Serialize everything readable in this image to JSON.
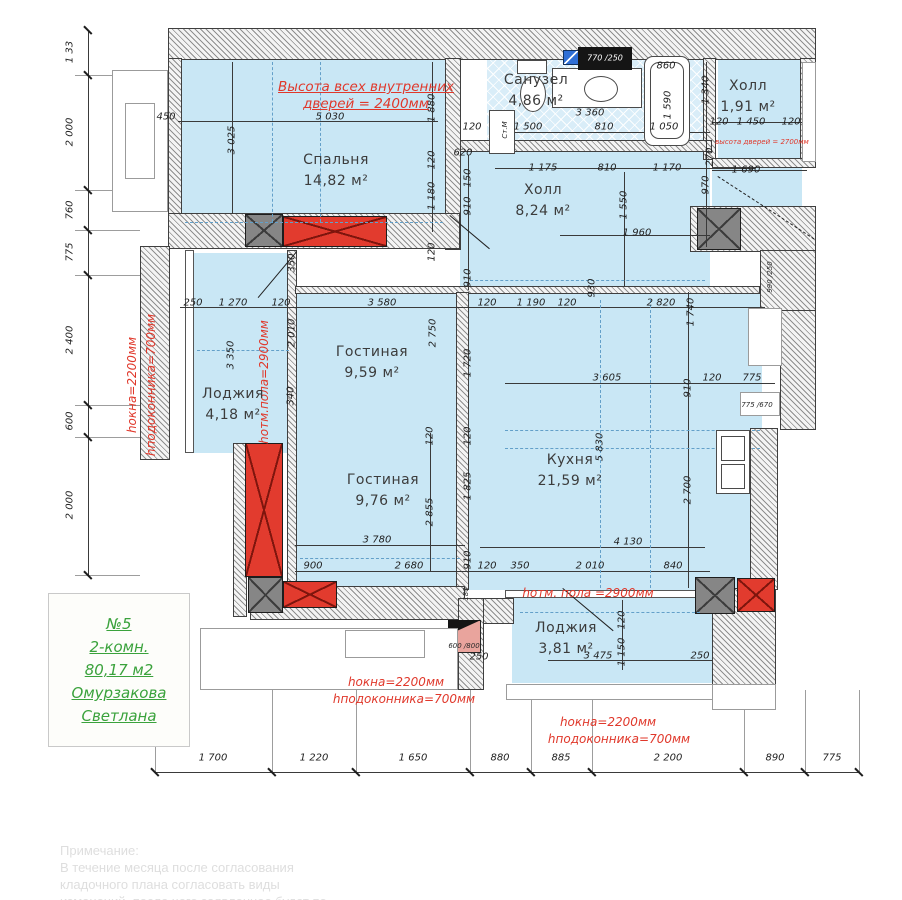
{
  "colors": {
    "room_fill": "#c9e7f5",
    "wall_hatch": "#8f8f8f",
    "vent_red": "#e23b2e",
    "shaft_gray": "#868686",
    "annotation_red": "#e0382b",
    "info_green": "#3aa23c",
    "panel_blue": "#2f6fd6"
  },
  "info_box": {
    "lines": [
      "№5",
      "2-комн.",
      "80,17 м2",
      "Омурзакова",
      "Светлана"
    ]
  },
  "note": {
    "lines": [
      "Примечание:",
      "  В течение месяца после согласования",
      "кладочного   плана   согласовать   виды",
      "изменений, после чего заявленное будет по"
    ]
  },
  "rooms": [
    {
      "name": "Спальня",
      "area": "14,82 м²",
      "x": 336,
      "y": 160
    },
    {
      "name": "Санузел",
      "area": "4,86 м²",
      "x": 536,
      "y": 80
    },
    {
      "name": "Холл",
      "area": "1,91 м²",
      "x": 748,
      "y": 86
    },
    {
      "name": "Холл",
      "area": "8,24 м²",
      "x": 543,
      "y": 190
    },
    {
      "name": "Гостиная",
      "area": "9,59 м²",
      "x": 372,
      "y": 352
    },
    {
      "name": "Лоджия",
      "area": "4,18 м²",
      "x": 233,
      "y": 394
    },
    {
      "name": "Гостиная",
      "area": "9,76 м²",
      "x": 383,
      "y": 480
    },
    {
      "name": "Кухня",
      "area": "21,59 м²",
      "x": 570,
      "y": 460
    },
    {
      "name": "Лоджия",
      "area": "3,81 м²",
      "x": 566,
      "y": 628
    }
  ],
  "red_notes": [
    {
      "t": "Высота всех внутренних",
      "x": 366,
      "y": 87,
      "r": 0,
      "c": "ru"
    },
    {
      "t": "дверей = 2400мм",
      "x": 366,
      "y": 104,
      "r": 0,
      "c": "ru"
    },
    {
      "t": "hокна=2200мм",
      "x": 132,
      "y": 385,
      "r": -90,
      "c": "r"
    },
    {
      "t": "hподоконника=700мм",
      "x": 151,
      "y": 385,
      "r": -90,
      "c": "r"
    },
    {
      "t": "hотм.пола=2900мм",
      "x": 264,
      "y": 382,
      "r": -90,
      "c": "r"
    },
    {
      "t": "hотм. пола =2900мм",
      "x": 588,
      "y": 593,
      "r": 0,
      "c": "r"
    },
    {
      "t": "высота дверей = 2700мм",
      "x": 762,
      "y": 142,
      "r": 0,
      "c": "rt"
    },
    {
      "t": "hокна=2200мм",
      "x": 396,
      "y": 682,
      "r": 0,
      "c": "r"
    },
    {
      "t": "hподоконника=700мм",
      "x": 404,
      "y": 699,
      "r": 0,
      "c": "r"
    },
    {
      "t": "hокна=2200мм",
      "x": 608,
      "y": 722,
      "r": 0,
      "c": "r"
    },
    {
      "t": "hподоконника=700мм",
      "x": 619,
      "y": 739,
      "r": 0,
      "c": "r"
    }
  ],
  "left_dims": [
    {
      "t": "1 33",
      "y": 52
    },
    {
      "t": "2 000",
      "y": 132
    },
    {
      "t": "760",
      "y": 210
    },
    {
      "t": "775",
      "y": 252
    },
    {
      "t": "2 400",
      "y": 340
    },
    {
      "t": "600",
      "y": 421
    },
    {
      "t": "2 000",
      "y": 505
    }
  ],
  "bottom_dims": [
    {
      "t": "1 700",
      "x": 213
    },
    {
      "t": "1 220",
      "x": 314
    },
    {
      "t": "1 650",
      "x": 413
    },
    {
      "t": "880",
      "x": 500
    },
    {
      "t": "885",
      "x": 561
    },
    {
      "t": "2 200",
      "x": 668
    },
    {
      "t": "890",
      "x": 775
    },
    {
      "t": "775",
      "x": 832
    }
  ],
  "dims": [
    {
      "t": "450",
      "x": 166,
      "y": 117
    },
    {
      "t": "5 030",
      "x": 330,
      "y": 117
    },
    {
      "t": "3 025",
      "x": 232,
      "y": 140,
      "r": -90
    },
    {
      "t": "620",
      "x": 463,
      "y": 153
    },
    {
      "t": "1 880",
      "x": 432,
      "y": 108,
      "r": -90
    },
    {
      "t": "120",
      "x": 432,
      "y": 160,
      "r": -90
    },
    {
      "t": "1 180",
      "x": 432,
      "y": 196,
      "r": -90
    },
    {
      "t": "150",
      "x": 468,
      "y": 178,
      "r": -90
    },
    {
      "t": "910",
      "x": 468,
      "y": 206,
      "r": -90
    },
    {
      "t": "910",
      "x": 468,
      "y": 278,
      "r": -90
    },
    {
      "t": "120",
      "x": 432,
      "y": 252,
      "r": -90
    },
    {
      "t": "120",
      "x": 472,
      "y": 127
    },
    {
      "t": "1 500",
      "x": 528,
      "y": 127
    },
    {
      "t": "810",
      "x": 604,
      "y": 127
    },
    {
      "t": "1 050",
      "x": 664,
      "y": 127
    },
    {
      "t": "3 360",
      "x": 590,
      "y": 113
    },
    {
      "t": "860",
      "x": 666,
      "y": 66
    },
    {
      "t": "1 590",
      "x": 668,
      "y": 105,
      "r": -90
    },
    {
      "t": "Ст.М",
      "x": 505,
      "y": 130,
      "r": -90,
      "c": "dt"
    },
    {
      "t": "770 /250",
      "x": 605,
      "y": 58,
      "c": "wh"
    },
    {
      "t": "1 340",
      "x": 706,
      "y": 90,
      "r": -90
    },
    {
      "t": "120",
      "x": 719,
      "y": 122
    },
    {
      "t": "1 450",
      "x": 751,
      "y": 122
    },
    {
      "t": "120",
      "x": 791,
      "y": 122
    },
    {
      "t": "1 175",
      "x": 543,
      "y": 168
    },
    {
      "t": "810",
      "x": 607,
      "y": 168
    },
    {
      "t": "1 170",
      "x": 667,
      "y": 168
    },
    {
      "t": "1 690",
      "x": 746,
      "y": 170
    },
    {
      "t": "1 550",
      "x": 624,
      "y": 205,
      "r": -90
    },
    {
      "t": "1 960",
      "x": 637,
      "y": 233
    },
    {
      "t": "970",
      "x": 706,
      "y": 185,
      "r": -90
    },
    {
      "t": "270",
      "x": 710,
      "y": 157,
      "r": -90
    },
    {
      "t": "930",
      "x": 592,
      "y": 288,
      "r": -90
    },
    {
      "t": "990 /250",
      "x": 770,
      "y": 277,
      "r": -90,
      "c": "dt"
    },
    {
      "t": "250",
      "x": 193,
      "y": 303
    },
    {
      "t": "1 270",
      "x": 233,
      "y": 303
    },
    {
      "t": "120",
      "x": 281,
      "y": 303
    },
    {
      "t": "3 580",
      "x": 382,
      "y": 303
    },
    {
      "t": "120",
      "x": 487,
      "y": 303
    },
    {
      "t": "1 190",
      "x": 531,
      "y": 303
    },
    {
      "t": "120",
      "x": 567,
      "y": 303
    },
    {
      "t": "2 820",
      "x": 661,
      "y": 303
    },
    {
      "t": "1 740",
      "x": 691,
      "y": 312,
      "r": -90
    },
    {
      "t": "350",
      "x": 292,
      "y": 263,
      "r": -90
    },
    {
      "t": "2 010",
      "x": 292,
      "y": 333,
      "r": -90
    },
    {
      "t": "340",
      "x": 291,
      "y": 396,
      "r": -90
    },
    {
      "t": "3 350",
      "x": 231,
      "y": 355,
      "r": -90
    },
    {
      "t": "2 750",
      "x": 433,
      "y": 333,
      "r": -90
    },
    {
      "t": "1 720",
      "x": 468,
      "y": 363,
      "r": -90
    },
    {
      "t": "3 605",
      "x": 607,
      "y": 378
    },
    {
      "t": "910",
      "x": 688,
      "y": 388,
      "r": -90
    },
    {
      "t": "120",
      "x": 712,
      "y": 378
    },
    {
      "t": "775",
      "x": 752,
      "y": 378
    },
    {
      "t": "775 /670",
      "x": 757,
      "y": 405,
      "c": "dt"
    },
    {
      "t": "5 830",
      "x": 600,
      "y": 447,
      "r": -90
    },
    {
      "t": "2 700",
      "x": 688,
      "y": 490,
      "r": -90
    },
    {
      "t": "2 855",
      "x": 430,
      "y": 512,
      "r": -90
    },
    {
      "t": "1 825",
      "x": 468,
      "y": 486,
      "r": -90
    },
    {
      "t": "120",
      "x": 430,
      "y": 436,
      "r": -90
    },
    {
      "t": "120",
      "x": 468,
      "y": 436,
      "r": -90
    },
    {
      "t": "3 780",
      "x": 377,
      "y": 540
    },
    {
      "t": "900",
      "x": 313,
      "y": 566
    },
    {
      "t": "2 680",
      "x": 409,
      "y": 566
    },
    {
      "t": "910",
      "x": 468,
      "y": 560,
      "r": -90
    },
    {
      "t": "120",
      "x": 487,
      "y": 566
    },
    {
      "t": "350",
      "x": 520,
      "y": 566
    },
    {
      "t": "2 010",
      "x": 590,
      "y": 566
    },
    {
      "t": "840",
      "x": 673,
      "y": 566
    },
    {
      "t": "4 130",
      "x": 628,
      "y": 542
    },
    {
      "t": "120",
      "x": 622,
      "y": 620,
      "r": -90
    },
    {
      "t": "3 475",
      "x": 598,
      "y": 656
    },
    {
      "t": "1 150",
      "x": 622,
      "y": 652,
      "r": -90
    },
    {
      "t": "250",
      "x": 479,
      "y": 657
    },
    {
      "t": "250",
      "x": 700,
      "y": 656
    },
    {
      "t": "180",
      "x": 466,
      "y": 594,
      "r": -90,
      "c": "dt"
    },
    {
      "t": "600 /800",
      "x": 464,
      "y": 646,
      "c": "dt"
    }
  ],
  "fills": [
    {
      "x": 175,
      "y": 58,
      "w": 270,
      "h": 174
    },
    {
      "x": 487,
      "y": 58,
      "w": 216,
      "h": 90,
      "k": "tile"
    },
    {
      "x": 718,
      "y": 58,
      "w": 85,
      "h": 105
    },
    {
      "x": 712,
      "y": 168,
      "w": 90,
      "h": 82
    },
    {
      "x": 460,
      "y": 152,
      "w": 250,
      "h": 138
    },
    {
      "x": 295,
      "y": 290,
      "w": 467,
      "h": 300
    },
    {
      "x": 192,
      "y": 253,
      "w": 100,
      "h": 200
    },
    {
      "x": 512,
      "y": 595,
      "w": 200,
      "h": 88
    }
  ],
  "walls": [
    {
      "x": 168,
      "y": 28,
      "w": 648,
      "h": 32
    },
    {
      "x": 168,
      "y": 58,
      "w": 14,
      "h": 190
    },
    {
      "x": 445,
      "y": 58,
      "w": 16,
      "h": 192
    },
    {
      "x": 800,
      "y": 58,
      "w": 16,
      "h": 106
    },
    {
      "x": 703,
      "y": 58,
      "w": 13,
      "h": 102
    },
    {
      "x": 460,
      "y": 140,
      "w": 252,
      "h": 12
    },
    {
      "x": 712,
      "y": 158,
      "w": 104,
      "h": 10
    },
    {
      "x": 168,
      "y": 213,
      "w": 292,
      "h": 36
    },
    {
      "x": 690,
      "y": 206,
      "w": 126,
      "h": 46
    },
    {
      "x": 140,
      "y": 246,
      "w": 30,
      "h": 214
    },
    {
      "x": 185,
      "y": 250,
      "w": 9,
      "h": 203,
      "k": "thin"
    },
    {
      "x": 287,
      "y": 250,
      "w": 10,
      "h": 340
    },
    {
      "x": 295,
      "y": 286,
      "w": 465,
      "h": 8
    },
    {
      "x": 456,
      "y": 292,
      "w": 13,
      "h": 298
    },
    {
      "x": 233,
      "y": 443,
      "w": 14,
      "h": 174
    },
    {
      "x": 250,
      "y": 586,
      "w": 215,
      "h": 34
    },
    {
      "x": 458,
      "y": 598,
      "w": 56,
      "h": 26
    },
    {
      "x": 458,
      "y": 598,
      "w": 26,
      "h": 92
    },
    {
      "x": 505,
      "y": 590,
      "w": 210,
      "h": 8,
      "k": "thin"
    },
    {
      "x": 712,
      "y": 588,
      "w": 64,
      "h": 98
    },
    {
      "x": 760,
      "y": 250,
      "w": 56,
      "h": 62
    },
    {
      "x": 780,
      "y": 310,
      "w": 36,
      "h": 120
    },
    {
      "x": 750,
      "y": 428,
      "w": 28,
      "h": 162
    }
  ],
  "xblocks": [
    {
      "x": 283,
      "y": 216,
      "w": 104,
      "h": 31,
      "k": "red"
    },
    {
      "x": 245,
      "y": 443,
      "w": 38,
      "h": 134,
      "k": "red"
    },
    {
      "x": 283,
      "y": 581,
      "w": 54,
      "h": 27,
      "k": "red"
    },
    {
      "x": 737,
      "y": 578,
      "w": 38,
      "h": 34,
      "k": "red"
    },
    {
      "x": 245,
      "y": 214,
      "w": 38,
      "h": 33,
      "k": "gray"
    },
    {
      "x": 697,
      "y": 208,
      "w": 44,
      "h": 42,
      "k": "gray"
    },
    {
      "x": 248,
      "y": 577,
      "w": 35,
      "h": 36,
      "k": "gray"
    },
    {
      "x": 695,
      "y": 577,
      "w": 40,
      "h": 37,
      "k": "gray"
    }
  ],
  "lines": [
    {
      "x": 88,
      "y": 30,
      "w": 1,
      "h": 545
    },
    {
      "x": 155,
      "y": 772,
      "w": 705,
      "h": 1
    },
    {
      "x": 178,
      "y": 121,
      "w": 260,
      "h": 1
    },
    {
      "x": 495,
      "y": 132,
      "w": 215,
      "h": 1
    },
    {
      "x": 495,
      "y": 168,
      "w": 260,
      "h": 1
    },
    {
      "x": 712,
      "y": 122,
      "w": 95,
      "h": 1
    },
    {
      "x": 712,
      "y": 170,
      "w": 95,
      "h": 1
    },
    {
      "x": 560,
      "y": 235,
      "w": 150,
      "h": 1
    },
    {
      "x": 180,
      "y": 307,
      "w": 585,
      "h": 1
    },
    {
      "x": 505,
      "y": 383,
      "w": 270,
      "h": 1
    },
    {
      "x": 295,
      "y": 545,
      "w": 170,
      "h": 1
    },
    {
      "x": 480,
      "y": 547,
      "w": 225,
      "h": 1
    },
    {
      "x": 295,
      "y": 571,
      "w": 415,
      "h": 1
    },
    {
      "x": 548,
      "y": 660,
      "w": 165,
      "h": 1
    },
    {
      "x": 232,
      "y": 62,
      "w": 1,
      "h": 152
    },
    {
      "x": 432,
      "y": 62,
      "w": 1,
      "h": 170
    },
    {
      "x": 468,
      "y": 155,
      "w": 1,
      "h": 135
    },
    {
      "x": 624,
      "y": 172,
      "w": 1,
      "h": 115
    },
    {
      "x": 688,
      "y": 292,
      "w": 1,
      "h": 296
    },
    {
      "x": 706,
      "y": 62,
      "w": 1,
      "h": 185
    },
    {
      "x": 430,
      "y": 433,
      "w": 1,
      "h": 138
    },
    {
      "x": 468,
      "y": 433,
      "w": 1,
      "h": 138
    },
    {
      "x": 622,
      "y": 600,
      "w": 1,
      "h": 70
    },
    {
      "x": 75,
      "y": 75,
      "w": 65,
      "h": 1,
      "k": "lt"
    },
    {
      "x": 75,
      "y": 190,
      "w": 65,
      "h": 1,
      "k": "lt"
    },
    {
      "x": 75,
      "y": 230,
      "w": 65,
      "h": 1,
      "k": "lt"
    },
    {
      "x": 75,
      "y": 275,
      "w": 65,
      "h": 1,
      "k": "lt"
    },
    {
      "x": 75,
      "y": 405,
      "w": 65,
      "h": 1,
      "k": "lt"
    },
    {
      "x": 75,
      "y": 437,
      "w": 65,
      "h": 1,
      "k": "lt"
    },
    {
      "x": 75,
      "y": 575,
      "w": 65,
      "h": 1,
      "k": "lt"
    },
    {
      "x": 155,
      "y": 690,
      "w": 1,
      "h": 82,
      "k": "lt"
    },
    {
      "x": 272,
      "y": 690,
      "w": 1,
      "h": 82,
      "k": "lt"
    },
    {
      "x": 356,
      "y": 690,
      "w": 1,
      "h": 82,
      "k": "lt"
    },
    {
      "x": 470,
      "y": 690,
      "w": 1,
      "h": 82,
      "k": "lt"
    },
    {
      "x": 531,
      "y": 690,
      "w": 1,
      "h": 82,
      "k": "lt"
    },
    {
      "x": 592,
      "y": 690,
      "w": 1,
      "h": 82,
      "k": "lt"
    },
    {
      "x": 744,
      "y": 690,
      "w": 1,
      "h": 82,
      "k": "lt"
    },
    {
      "x": 805,
      "y": 690,
      "w": 1,
      "h": 82,
      "k": "lt"
    },
    {
      "x": 859,
      "y": 690,
      "w": 1,
      "h": 82,
      "k": "lt"
    }
  ],
  "dashes": [
    {
      "x": 272,
      "y": 62,
      "w": 1,
      "h": 160,
      "k": "v"
    },
    {
      "x": 320,
      "y": 62,
      "w": 1,
      "h": 160,
      "k": "v"
    },
    {
      "x": 185,
      "y": 222,
      "w": 258,
      "h": 1,
      "k": "h"
    },
    {
      "x": 470,
      "y": 280,
      "w": 235,
      "h": 1,
      "k": "h"
    },
    {
      "x": 600,
      "y": 300,
      "w": 1,
      "h": 288,
      "k": "v"
    },
    {
      "x": 650,
      "y": 300,
      "w": 1,
      "h": 288,
      "k": "v"
    },
    {
      "x": 505,
      "y": 430,
      "w": 255,
      "h": 1,
      "k": "h"
    },
    {
      "x": 505,
      "y": 448,
      "w": 255,
      "h": 1,
      "k": "h"
    },
    {
      "x": 300,
      "y": 558,
      "w": 160,
      "h": 1,
      "k": "h"
    },
    {
      "x": 520,
      "y": 612,
      "w": 180,
      "h": 1,
      "k": "h"
    },
    {
      "x": 197,
      "y": 350,
      "w": 92,
      "h": 1,
      "k": "h"
    }
  ],
  "diags": [
    {
      "x": 563,
      "y": 588,
      "len": 66,
      "ang": 40
    },
    {
      "x": 297,
      "y": 252,
      "len": 60,
      "ang": 130
    },
    {
      "x": 450,
      "y": 215,
      "len": 52,
      "ang": 40
    },
    {
      "x": 718,
      "y": 176,
      "len": 115,
      "ang": 33,
      "k": "dd"
    }
  ],
  "ticks": {
    "left_x": 88,
    "left_ys": [
      30,
      75,
      190,
      230,
      275,
      405,
      437,
      575
    ],
    "bottom_y": 772,
    "bottom_xs": [
      155,
      272,
      356,
      470,
      531,
      592,
      744,
      805,
      859
    ]
  },
  "shapes": [
    {
      "k": "fxl",
      "x": 112,
      "y": 70,
      "w": 56,
      "h": 142
    },
    {
      "k": "fxl",
      "x": 125,
      "y": 103,
      "w": 30,
      "h": 76
    },
    {
      "k": "fx",
      "x": 517,
      "y": 60,
      "w": 30,
      "h": 14
    },
    {
      "k": "fx ell",
      "x": 520,
      "y": 76,
      "w": 26,
      "h": 36
    },
    {
      "k": "fx",
      "x": 552,
      "y": 68,
      "w": 90,
      "h": 40
    },
    {
      "k": "fx ell",
      "x": 584,
      "y": 76,
      "w": 34,
      "h": 26
    },
    {
      "k": "fx rr",
      "x": 644,
      "y": 56,
      "w": 46,
      "h": 90
    },
    {
      "k": "fx rr",
      "x": 650,
      "y": 62,
      "w": 34,
      "h": 77
    },
    {
      "k": "fx",
      "x": 489,
      "y": 110,
      "w": 26,
      "h": 44
    },
    {
      "k": "fx",
      "x": 716,
      "y": 430,
      "w": 34,
      "h": 64
    },
    {
      "k": "fx",
      "x": 721,
      "y": 436,
      "w": 24,
      "h": 25
    },
    {
      "k": "fx",
      "x": 721,
      "y": 464,
      "w": 24,
      "h": 25
    },
    {
      "k": "blu",
      "x": 563,
      "y": 50,
      "w": 16,
      "h": 15
    },
    {
      "k": "blu",
      "x": 755,
      "y": 315,
      "w": 20,
      "h": 18
    },
    {
      "k": "blu",
      "x": 755,
      "y": 342,
      "w": 20,
      "h": 18
    },
    {
      "k": "blk",
      "x": 578,
      "y": 47,
      "w": 54,
      "h": 23
    },
    {
      "k": "fxl",
      "x": 748,
      "y": 308,
      "w": 34,
      "h": 58
    },
    {
      "k": "fxl",
      "x": 740,
      "y": 392,
      "w": 40,
      "h": 24
    },
    {
      "k": "pnk",
      "x": 448,
      "y": 620,
      "w": 33,
      "h": 33
    },
    {
      "k": "tri",
      "x": 448,
      "y": 620,
      "w": 33,
      "h": 15
    },
    {
      "k": "fxl",
      "x": 200,
      "y": 628,
      "w": 258,
      "h": 62
    },
    {
      "k": "fxl",
      "x": 345,
      "y": 630,
      "w": 80,
      "h": 28
    },
    {
      "k": "fxl",
      "x": 506,
      "y": 684,
      "w": 210,
      "h": 16
    },
    {
      "k": "fxl",
      "x": 712,
      "y": 684,
      "w": 64,
      "h": 26
    },
    {
      "k": "fxl",
      "x": 802,
      "y": 62,
      "w": 14,
      "h": 100
    }
  ]
}
